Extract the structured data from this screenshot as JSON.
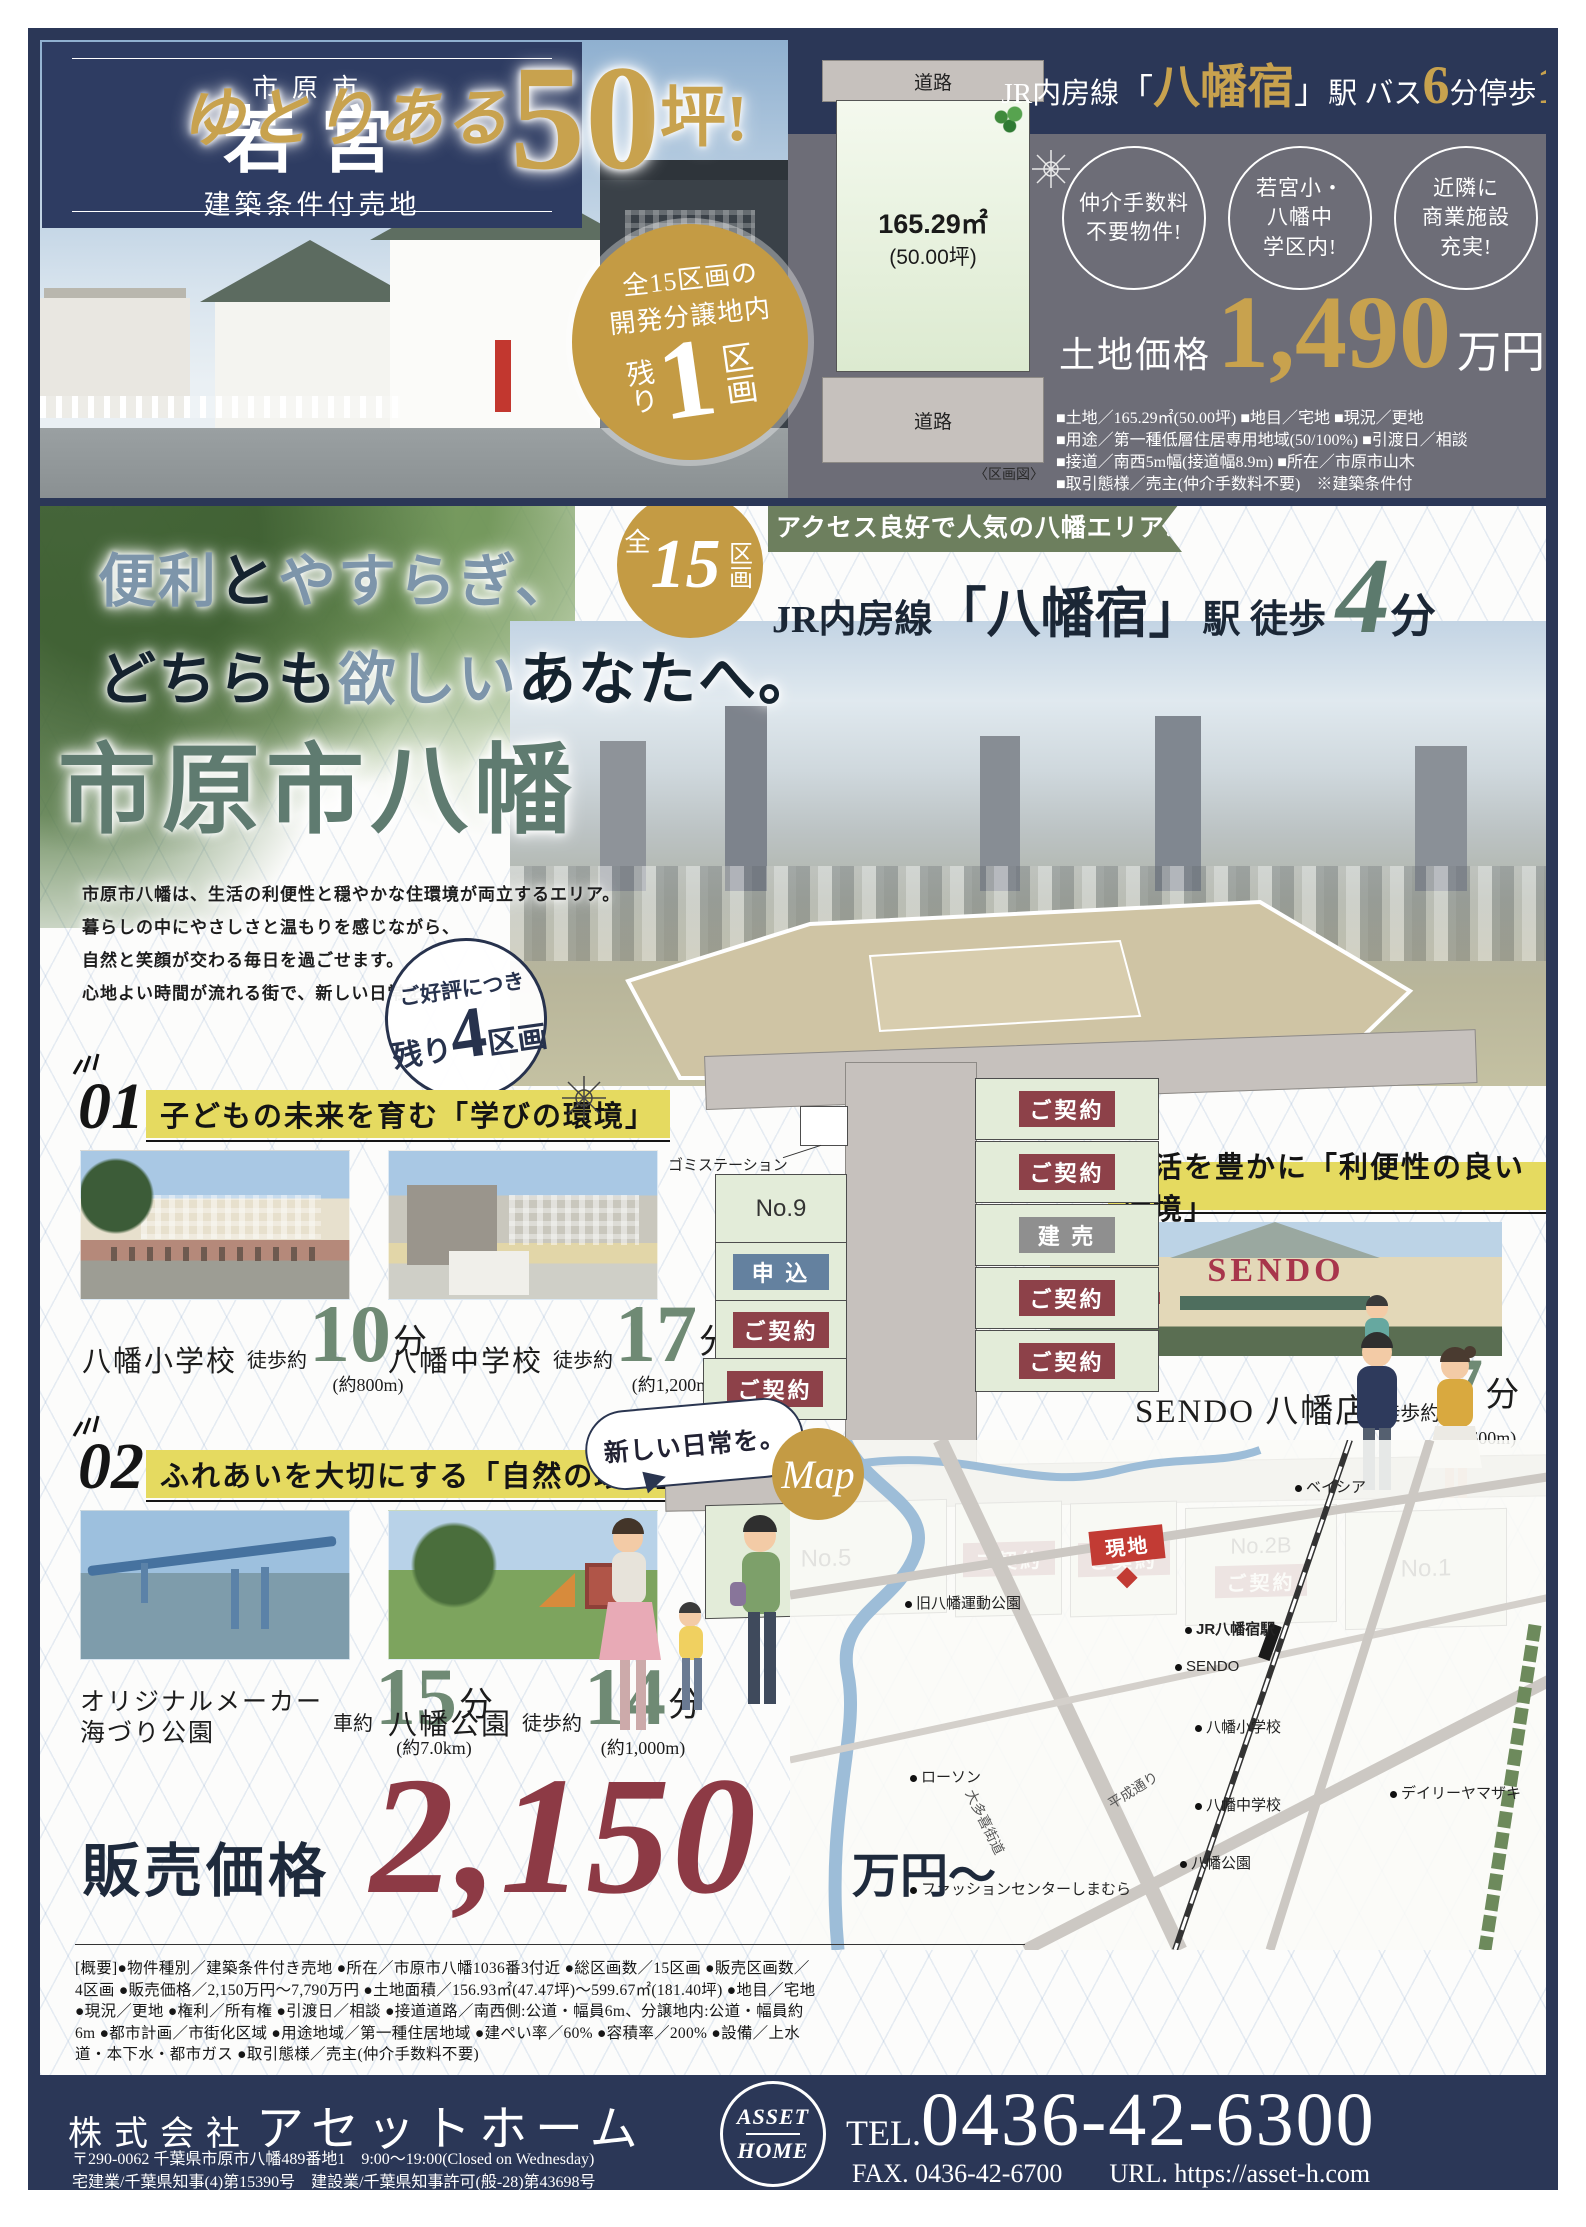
{
  "top": {
    "city": "市原市",
    "name": "若宮",
    "category": "建築条件付売地",
    "headline": {
      "script": "ゆとりある",
      "num": "50",
      "unit": "坪!"
    },
    "badge": {
      "line1": "全15区画の",
      "line2": "開発分譲地内",
      "pre": "残り",
      "num": "1",
      "suf": "区画"
    },
    "plot": {
      "road_top": "道路",
      "area": "165.29㎡",
      "tsubo": "(50.00坪)",
      "road_bottom": "道路",
      "caption": "〈区画図〉"
    },
    "rail": {
      "pre": "JR内房線",
      "bl": "「",
      "station": "八幡宿",
      "br": "」",
      "mid1": "駅 バス",
      "num1": "6",
      "mid2": "分停歩",
      "num2": "1",
      "suf": "分"
    },
    "features": [
      [
        "仲介手数料",
        "不要物件!"
      ],
      [
        "若宮小・",
        "八幡中",
        "学区内!"
      ],
      [
        "近隣に",
        "商業施設",
        "充実!"
      ]
    ],
    "price": {
      "label": "土地価格",
      "value": "1,490",
      "unit": "万円"
    },
    "specs": [
      "■土地／165.29㎡(50.00坪) ■地目／宅地 ■現況／更地",
      "■用途／第一種低層住居専用地域(50/100%) ■引渡日／相談",
      "■接道／南西5m幅(接道幅8.9m) ■所在／市原市山木",
      "■取引態様／売主(仲介手数料不要)　※建築条件付"
    ]
  },
  "main": {
    "catch": {
      "w1": "便利",
      "w2": "と",
      "w3": "やすらぎ、",
      "w4": "どちらも",
      "w5": "欲しい",
      "w6": "あなたへ。"
    },
    "lots15": {
      "pre": "全",
      "num": "15",
      "suf": "区画"
    },
    "title": "市原市八幡",
    "para": [
      "市原市八幡は、生活の利便性と穏やかな住環境が両立するエリア。",
      "暮らしの中にやさしさと温もりを感じながら、",
      "自然と笑顔が交わる毎日を過ごせます。",
      "心地よい時間が流れる街で、新しい日常を。"
    ],
    "remain": {
      "top": "ご好評につき",
      "pre": "残り",
      "num": "4",
      "suf": "区画"
    },
    "ribbon": "アクセス良好で人気の八幡エリア!",
    "access": {
      "pre": "JR内房線",
      "station": "「八幡宿」",
      "mid": "駅 徒歩",
      "num": "4",
      "suf": "分"
    }
  },
  "points": {
    "p1": {
      "no": "01",
      "title": "子どもの未来を育む「学びの環境」",
      "a": {
        "name": "八幡小学校",
        "mode": "徒歩約",
        "num": "10",
        "unit": "分",
        "dist": "(約800m)"
      },
      "b": {
        "name": "八幡中学校",
        "mode": "徒歩約",
        "num": "17",
        "unit": "分",
        "dist": "(約1,200m)"
      }
    },
    "p2": {
      "no": "02",
      "title": "ふれあいを大切にする「自然の環境」",
      "a": {
        "name1": "オリジナルメーカー",
        "name2": "海づり公園",
        "mode": "車約",
        "num": "15",
        "unit": "分",
        "dist": "(約7.0km)"
      },
      "b": {
        "name": "八幡公園",
        "mode": "徒歩約",
        "num": "14",
        "unit": "分",
        "dist": "(約1,000m)"
      }
    },
    "p3": {
      "no": "03",
      "title": "生活を豊かに「利便性の良い環境」",
      "sign": "SENDO",
      "a": {
        "name": "SENDO 八幡店",
        "mode": "徒歩約",
        "num": "7",
        "unit": "分",
        "dist": "(約600m)"
      }
    }
  },
  "lotmap": {
    "trash": "ゴミステーション",
    "no9": "No.9",
    "apply": "申 込",
    "sold": "ご契約",
    "built": "建 売",
    "no5": "No.5",
    "no2b": "No.2B",
    "no1": "No.1"
  },
  "bubble": "新しい日常を。",
  "map": {
    "label": "Map",
    "site": "現地",
    "pois": [
      "ベイシア",
      "旧八幡運動公園",
      "JR八幡宿駅",
      "SENDO",
      "八幡小学校",
      "ローソン",
      "八幡中学校",
      "八幡公園",
      "ファッションセンターしまむら",
      "デイリーヤマザキ"
    ],
    "roads": [
      "平成通り",
      "大多喜街道"
    ]
  },
  "sale": {
    "label": "販売価格",
    "value": "2,150",
    "unit": "万円〜"
  },
  "overview": "[概要]●物件種別／建築条件付き売地 ●所在／市原市八幡1036番3付近 ●総区画数／15区画 ●販売区画数／4区画 ●販売価格／2,150万円〜7,790万円 ●土地面積／156.93㎡(47.47坪)〜599.67㎡(181.40坪) ●地目／宅地 ●現況／更地 ●権利／所有権 ●引渡日／相談 ●接道道路／南西側:公道・幅員6m、分譲地内:公道・幅員約6m ●都市計画／市街化区域 ●用途地域／第一種住居地域 ●建ぺい率／60% ●容積率／200% ●設備／上水道・本下水・都市ガス ●取引態様／売主(仲介手数料不要)",
  "footer": {
    "company_pre": "株式会社",
    "company": "アセットホーム",
    "address": "〒290-0062 千葉県市原市八幡489番地1　9:00〜19:00(Closed on Wednesday)",
    "license": "宅建業/千葉県知事(4)第15390号　建設業/千葉県知事許可(般-28)第43698号",
    "logo1": "ASSET",
    "logo2": "HOME",
    "tel_label": "TEL.",
    "tel": "0436-42-6300",
    "fax": "FAX. 0436-42-6700",
    "url": "URL. https://asset-h.com"
  },
  "colors": {
    "navy": "#2b3757",
    "gold": "#c8a24e",
    "green_banner": "#6d7f5e",
    "price_red": "#8d3a45",
    "site_red": "#c23b34",
    "apply_blue": "#64819f",
    "highlight_yellow": "#e5da60",
    "title_green": "#5f7b70"
  }
}
